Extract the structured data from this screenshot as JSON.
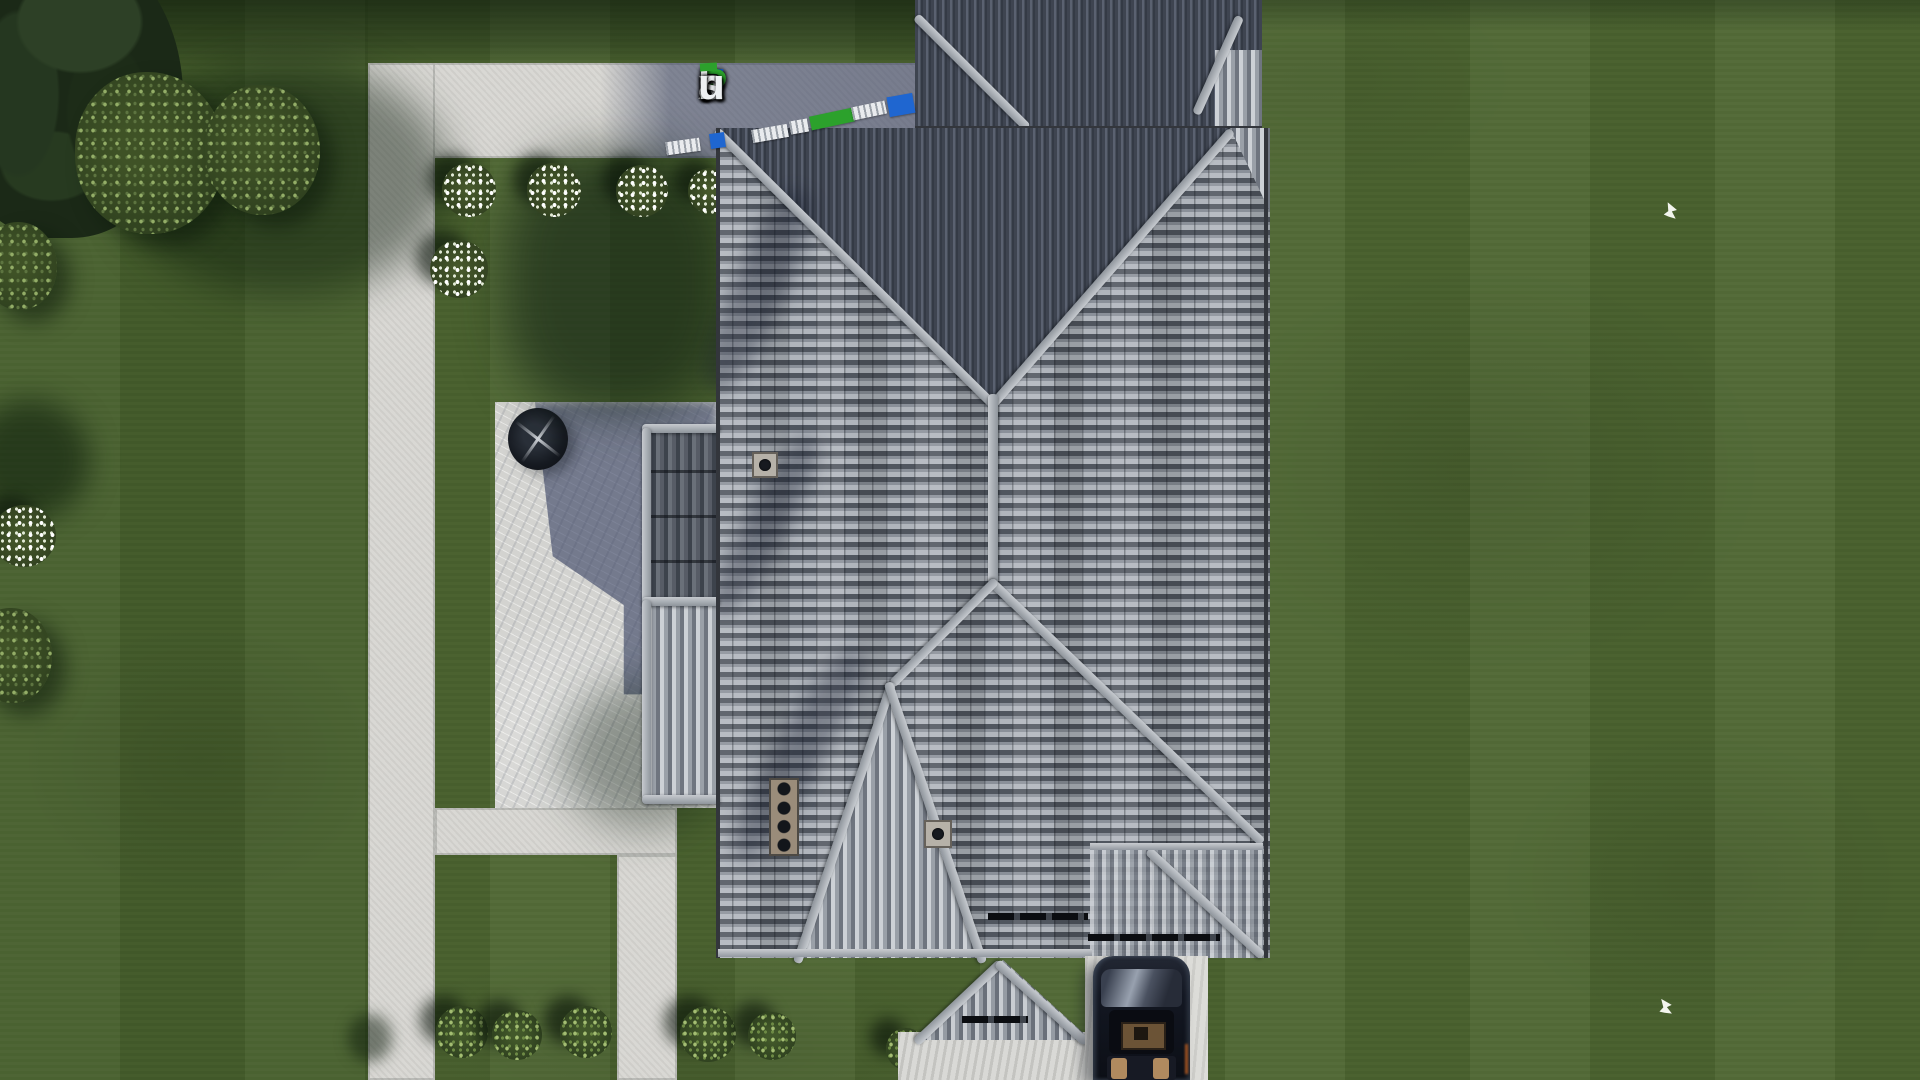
{
  "watermark": {
    "text": "FixPlans.ru",
    "letters": [
      {
        "ch": "F",
        "color": "#1f66d0"
      },
      {
        "ch": "i",
        "color": "#eef0f2"
      },
      {
        "ch": "x",
        "color": "#eef0f2"
      },
      {
        "ch": "P",
        "color": "#2ca12c"
      },
      {
        "ch": "l",
        "color": "#eef0f2"
      },
      {
        "ch": "a",
        "color": "#eef0f2"
      },
      {
        "ch": "n",
        "color": "#eef0f2"
      },
      {
        "ch": "s",
        "color": "#eef0f2"
      },
      {
        "ch": ".",
        "color": "#2ca12c"
      },
      {
        "ch": "r",
        "color": "#eef0f2"
      },
      {
        "ch": "u",
        "color": "#eef0f2"
      }
    ],
    "f_accent_color": "#2ca12c",
    "trail_chips": [
      {
        "color": "#e9ebee",
        "kind": "white-stamp"
      },
      {
        "color": "#1f66d0",
        "kind": "blue-stamp"
      },
      {
        "color": "#e9ebee",
        "kind": "white-stamp"
      },
      {
        "color": "#e9ebee",
        "kind": "white-stamp"
      },
      {
        "color": "#2ca12c",
        "kind": "green-stamp"
      },
      {
        "color": "#e9ebee",
        "kind": "white-stamp"
      },
      {
        "color": "#1f66d0",
        "kind": "blue-stamp"
      }
    ]
  },
  "scene": {
    "description": "Aerial top-down 3D render of a single-family house with a gray hip tile roof, rear roof block, left wing bays, front porch roof, stone patio with fire table, L-shaped concrete walkways, trimmed lawn with shrubs and flower bushes, a driveway with a dark parked car, and two white birds on the grass",
    "objects": [
      "hip-roof-house",
      "rear-roof-block",
      "left-wing-roof",
      "porch-roof",
      "stone-patio",
      "fire-table",
      "walkway-top",
      "walkway-left",
      "walkway-bottom",
      "walkway-leg",
      "driveway",
      "parked-car",
      "conifer-tree",
      "shrub-cluster",
      "flower-bushes",
      "green-bushes",
      "roof-vents",
      "birds"
    ]
  },
  "palette": {
    "grass": "#4c6530",
    "grass_shadow": "#263c1f",
    "path": "#d7d6d2",
    "path_shadow": "#6d7590",
    "roof_light": "#b0b5bc",
    "roof_mid": "#878d96",
    "roof_dark": "#50565f",
    "roof_top_slope": "#3f4550",
    "ridge": "#b5bac0",
    "patio": "#dededb",
    "patio_shadow": "#5a6582",
    "car_body": "#12151d",
    "car_interior": "#b08a5f",
    "bird": "#f2f4ee"
  },
  "counts": {
    "flower_bushes": 6,
    "green_bushes": 6,
    "birds": 2,
    "roof_vents": 3
  }
}
